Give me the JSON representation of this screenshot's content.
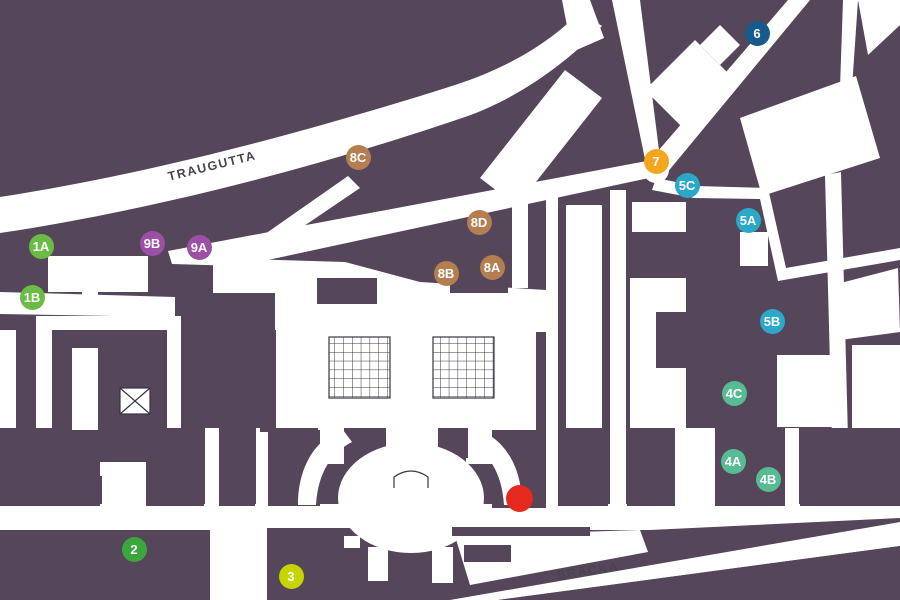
{
  "map": {
    "title": "campus-street-map",
    "colors": {
      "background": "#564659",
      "street": "#ffffff",
      "outline": "#3b3442",
      "label_text": "#4a4450",
      "poi": "#e5291c"
    },
    "street_labels": [
      {
        "name": "TRAUGUTTA",
        "x": 212,
        "y": 166,
        "angle": -14
      },
      {
        "name": "BRACKA",
        "x": 588,
        "y": 571,
        "angle": -8
      }
    ],
    "markers": [
      {
        "label": "1A",
        "x": 41,
        "y": 246,
        "color": "#6abc45"
      },
      {
        "label": "1B",
        "x": 32,
        "y": 297,
        "color": "#6abc45"
      },
      {
        "label": "2",
        "x": 134,
        "y": 549,
        "color": "#3aa63c"
      },
      {
        "label": "3",
        "x": 291,
        "y": 576,
        "color": "#c6d400"
      },
      {
        "label": "4A",
        "x": 733,
        "y": 461,
        "color": "#57bb93"
      },
      {
        "label": "4B",
        "x": 768,
        "y": 479,
        "color": "#57bb93"
      },
      {
        "label": "4C",
        "x": 734,
        "y": 393,
        "color": "#57bb93"
      },
      {
        "label": "5A",
        "x": 748,
        "y": 220,
        "color": "#2ba7c8"
      },
      {
        "label": "5B",
        "x": 772,
        "y": 321,
        "color": "#2ba7c8"
      },
      {
        "label": "5C",
        "x": 687,
        "y": 185,
        "color": "#2ba7c8"
      },
      {
        "label": "6",
        "x": 757,
        "y": 33,
        "color": "#175a8e"
      },
      {
        "label": "7",
        "x": 656,
        "y": 161,
        "color": "#f4a71d"
      },
      {
        "label": "8A",
        "x": 492,
        "y": 267,
        "color": "#b47e51"
      },
      {
        "label": "8B",
        "x": 446,
        "y": 273,
        "color": "#b47e51"
      },
      {
        "label": "8C",
        "x": 358,
        "y": 157,
        "color": "#b47e51"
      },
      {
        "label": "8D",
        "x": 479,
        "y": 222,
        "color": "#b47e51"
      },
      {
        "label": "9A",
        "x": 199,
        "y": 247,
        "color": "#9b4fa5"
      },
      {
        "label": "9B",
        "x": 152,
        "y": 243,
        "color": "#9b4fa5"
      }
    ],
    "poi": {
      "name": "highlighted-location",
      "x": 519,
      "y": 498
    }
  }
}
